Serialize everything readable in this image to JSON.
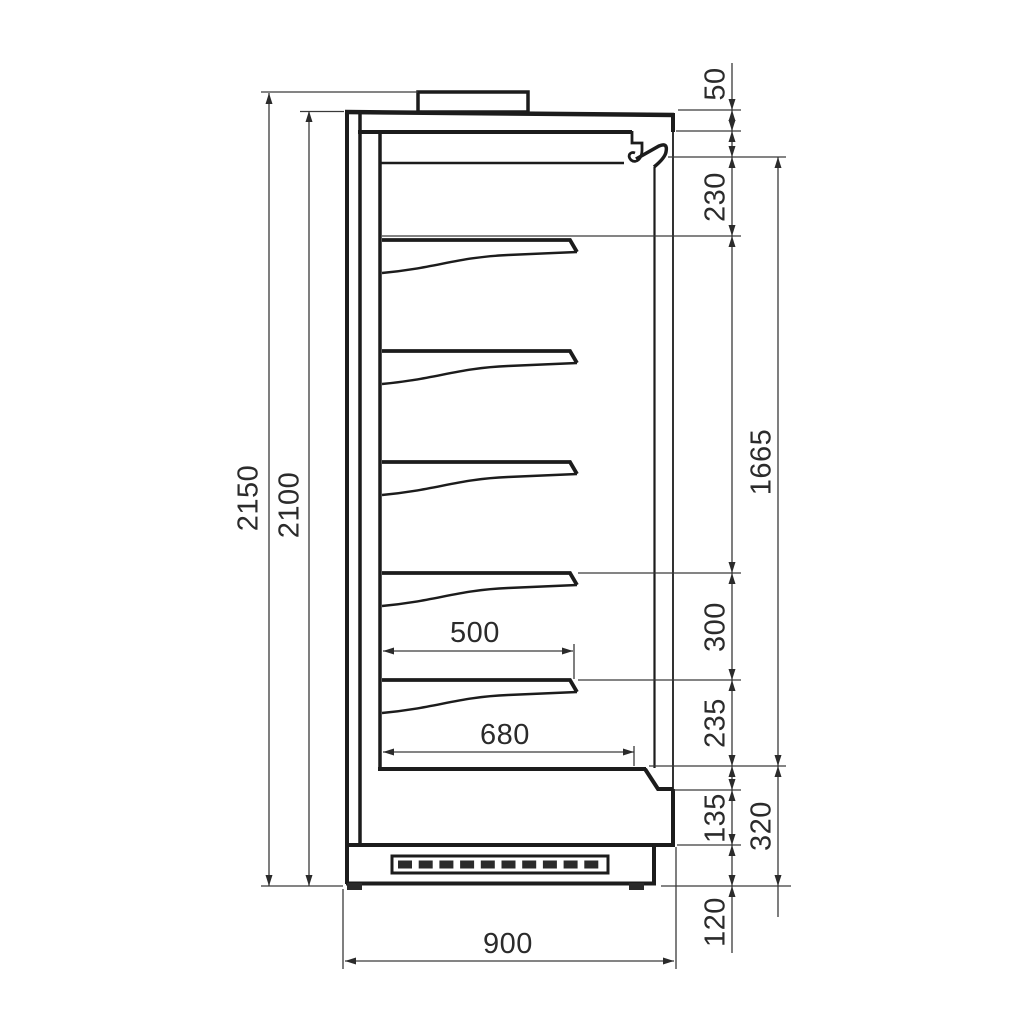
{
  "drawing": {
    "title": "Refrigerated multideck display cabinet — side cross-section",
    "type": "technical-dimension-drawing",
    "units": "mm",
    "shelf_count": 5,
    "line_color": "#1c1c1c",
    "background_color": "#ffffff"
  },
  "dims": {
    "overall_height": "2150",
    "body_height": "2100",
    "top_duct": "50",
    "canopy_to_first_shelf": "230",
    "display_opening": "1665",
    "shelf_spacing": "300",
    "shelf_to_deck": "235",
    "lower_front_panel": "135",
    "base_section": "320",
    "plinth_height": "120",
    "shelf_depth": "500",
    "deck_depth": "680",
    "overall_depth": "900"
  }
}
